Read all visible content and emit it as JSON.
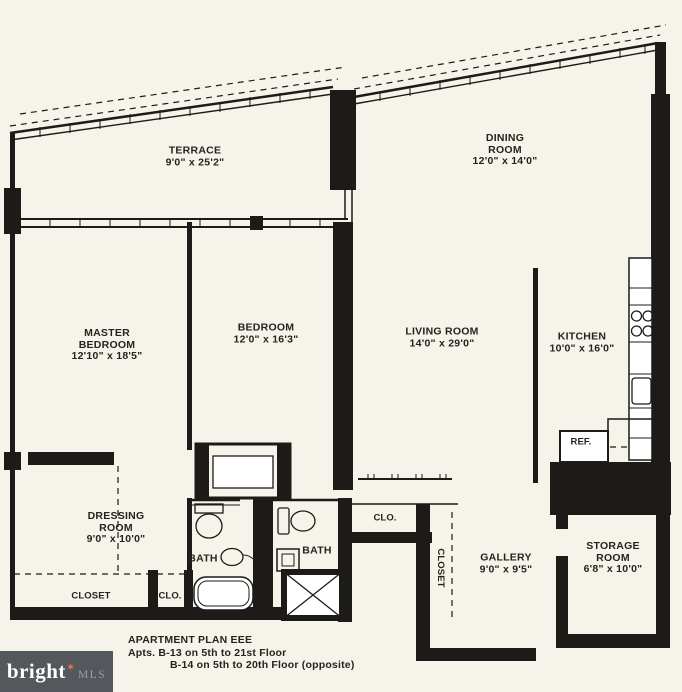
{
  "colors": {
    "background": "#f6f3ea",
    "line": "#1d1b18",
    "fixture_fill": "#ffffff",
    "watermark_bg": "#54575b"
  },
  "rooms": {
    "terrace": {
      "name": "TERRACE",
      "dims": "9'0\" x 25'2\""
    },
    "dining": {
      "name1": "DINING",
      "name2": "ROOM",
      "dims": "12'0\" x 14'0\""
    },
    "master_bedroom": {
      "name1": "MASTER",
      "name2": "BEDROOM",
      "dims": "12'10\" x 18'5\""
    },
    "bedroom": {
      "name": "BEDROOM",
      "dims": "12'0\" x 16'3\""
    },
    "living_room": {
      "name": "LIVING ROOM",
      "dims": "14'0\" x 29'0\""
    },
    "kitchen": {
      "name": "KITCHEN",
      "dims": "10'0\" x 16'0\""
    },
    "refrigerator": {
      "name": "REF."
    },
    "dressing_room": {
      "name1": "DRESSING",
      "name2": "ROOM",
      "dims": "9'0\" x 10'0\""
    },
    "bath_master": {
      "name": "BATH"
    },
    "bath_second": {
      "name": "BATH"
    },
    "closet_master": {
      "name": "CLOSET"
    },
    "clo_master": {
      "name": "CLO."
    },
    "clo_hall": {
      "name": "CLO."
    },
    "closet_gallery": {
      "name": "CLOSET"
    },
    "gallery": {
      "name": "GALLERY",
      "dims": "9'0\" x 9'5\""
    },
    "storage_room": {
      "name1": "STORAGE",
      "name2": "ROOM",
      "dims": "6'8\" x 10'0\""
    }
  },
  "title_block": {
    "plan_title": "APARTMENT PLAN EEE",
    "line1": "Apts. B-13 on 5th to 21st Floor",
    "line2": "B-14 on 5th to 20th Floor (opposite)"
  },
  "watermark": {
    "brand": "bright",
    "star": "✶",
    "suffix": "MLS"
  }
}
